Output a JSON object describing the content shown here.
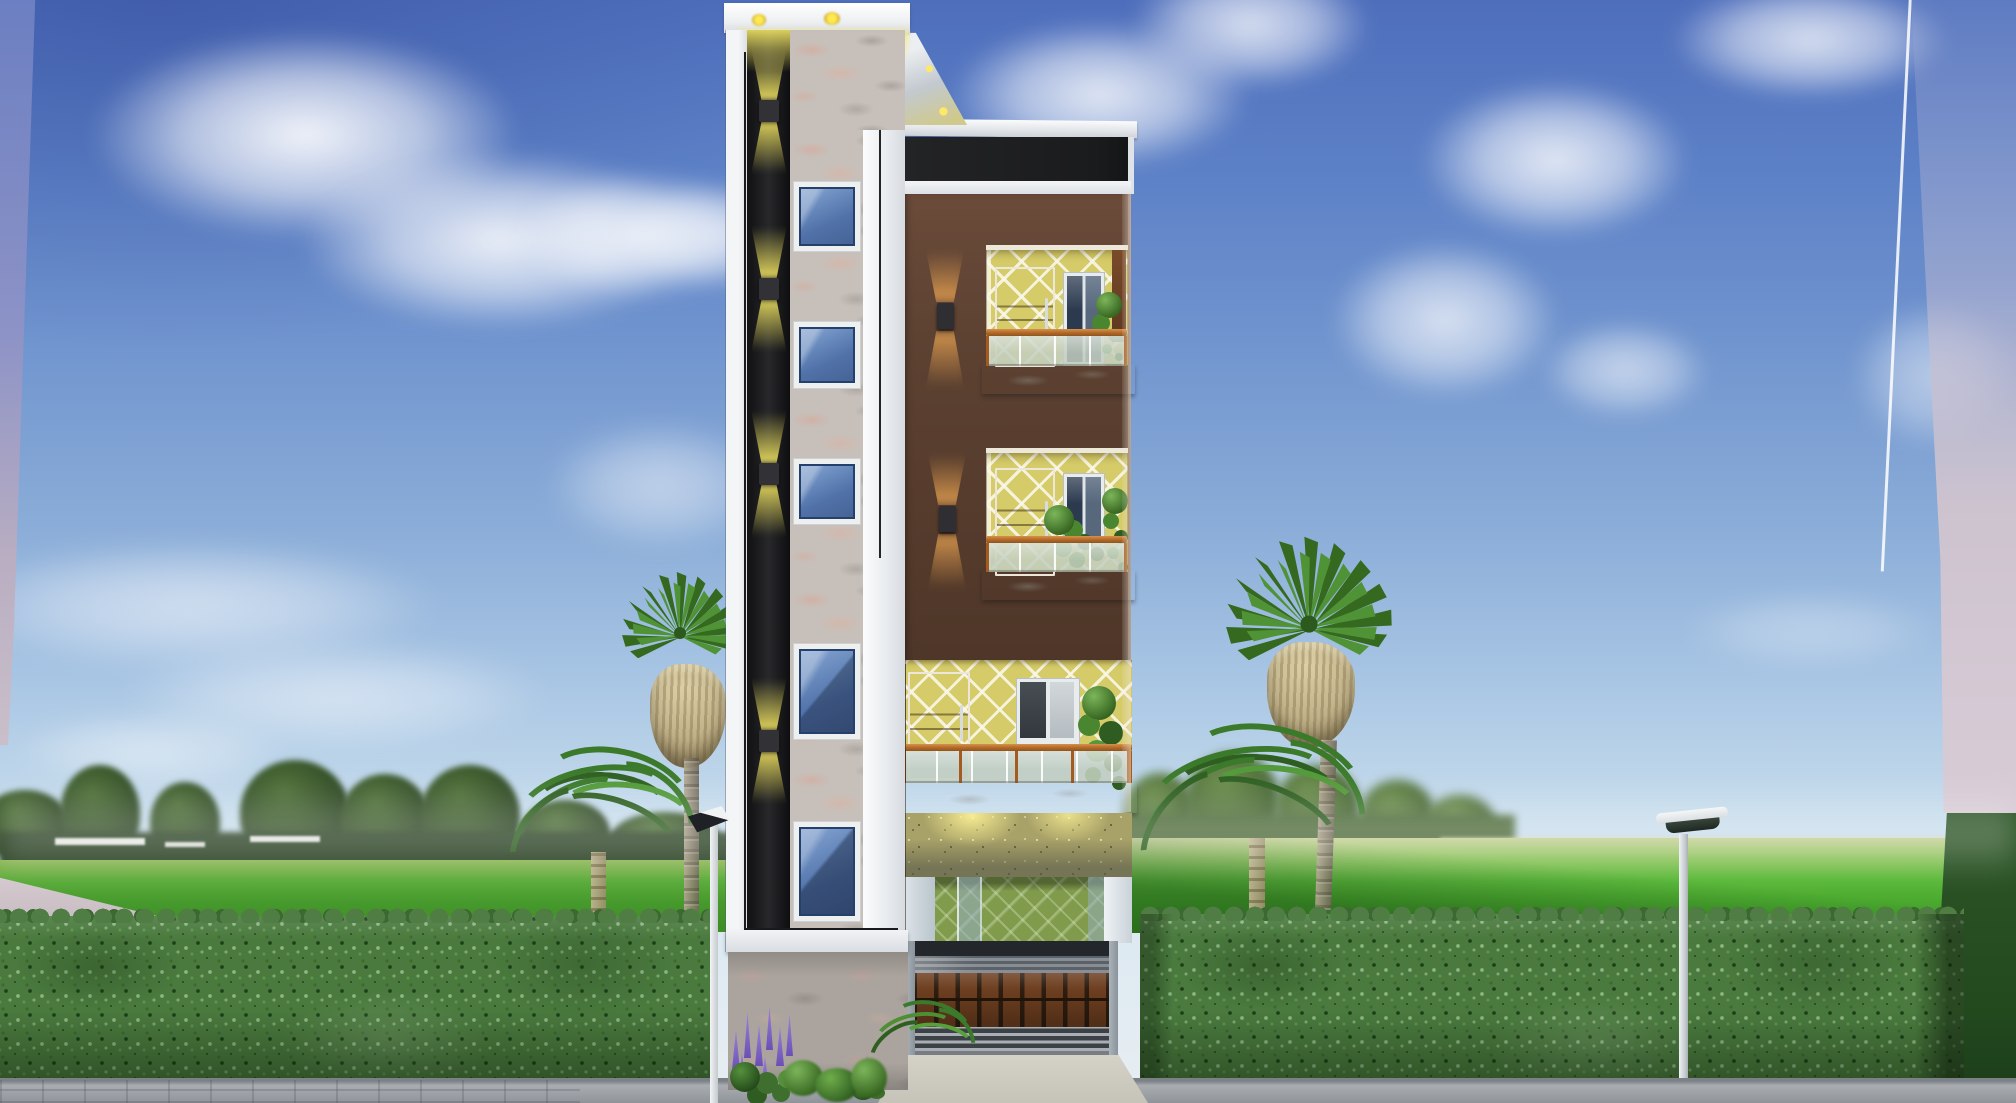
{
  "scene": {
    "type": "3d-architectural-elevation-render",
    "description": "Daytime 3D exterior render of a narrow four-storey residential building: a white tower with black accent strip, granite feature column and five blue glass windows on the left, and a chocolate-brown balcony block with yellow lattice walls, brown doors, glass railings, stone-clad ground floor, green porch and brown slatted garage shutter on the right; landscaped hedges, lawn, four palm trees, a street lamp and a solar path light under a blue sky with clouds.",
    "time_of_day": "day",
    "accent_lights_on": true
  },
  "building": {
    "left_tower": {
      "blue_windows": 5,
      "strip_wall_lights": 4,
      "parapet_downlights": 2,
      "materials": [
        "white-plaster",
        "black-accent-strip",
        "grey-granite-marble"
      ]
    },
    "right_block": {
      "facade_wall_lights": 2,
      "floors": [
        {
          "name": "top-floor-balcony",
          "door": "brown-flush-door",
          "window": "dark-glass-window",
          "wall": "yellow-diamond-lattice",
          "railing": "frosted-glass-with-timber-rail",
          "plants": true
        },
        {
          "name": "middle-floor-balcony",
          "door": "brown-flush-door",
          "window": "dark-glass-window",
          "wall": "yellow-diamond-lattice",
          "railing": "frosted-glass-with-timber-rail",
          "plants": true
        },
        {
          "name": "lower-floor-balcony",
          "door": "brown-flush-door",
          "window": "sliding-window",
          "wall": "yellow-diamond-lattice",
          "railing": "frosted-glass-with-timber-rail",
          "plants": true
        },
        {
          "name": "ground-floor",
          "features": [
            "stone-clad-feature-band",
            "green-lattice-porch",
            "brown-slatted-garage-shutter",
            "concrete-driveway"
          ]
        }
      ],
      "garage_panel_columns": 9,
      "garage_panel_rows": 2
    }
  },
  "landscape": {
    "palm_trees": 4,
    "hedge_rows": 2,
    "street_lamps": 1,
    "solar_path_lights": 1,
    "distant_people": 1,
    "flower_clusters": "purple",
    "background": [
      "tree-line",
      "open-lawn",
      "distant-field",
      "paved-sidewalk"
    ]
  },
  "colors": {
    "sky_top": "#4E6EBC",
    "sky_horizon": "#E7EEF3",
    "cloud": "#FFFFFF",
    "backdrop_left_top": "#6B7EC3",
    "backdrop_pink": "#D5C9D3",
    "treeline": "#2C4426",
    "grass_sunlit": "#58B838",
    "grass_shaded": "#3F9428",
    "far_field": "#C9D2A0",
    "hedge": "#4A7A3E",
    "pavement": "#9AA0A6",
    "driveway": "#D2CFC4",
    "tower_white": "#F2F4F6",
    "accent_black": "#141518",
    "granite_marble": "#C7C0BA",
    "window_glass_blue": "#4A6FAE",
    "window_frame_navy": "#23406B",
    "brown_wall": "#5A3E2E",
    "yellow_lattice": "#D5CB68",
    "lattice_line": "#F4F1DC",
    "porch_green": "#7F9B4B",
    "stone_band": "#A9A268",
    "balcony_slab": "#EFEEEA",
    "timber_rail": "#B06828",
    "frosted_glass": "#BCC8BA",
    "door_brown": "#7A4526",
    "garage_panel": "#6E3F20",
    "garage_frame": "#9AA2AA",
    "glow_yellow": "#EDE05E",
    "glow_warm": "#E0B050",
    "palm_green": "#3C7A2B",
    "palm_fiber": "#BFB188",
    "flower_purple": "#8A6FD0",
    "lamp_pole": "#E8ECEF"
  }
}
